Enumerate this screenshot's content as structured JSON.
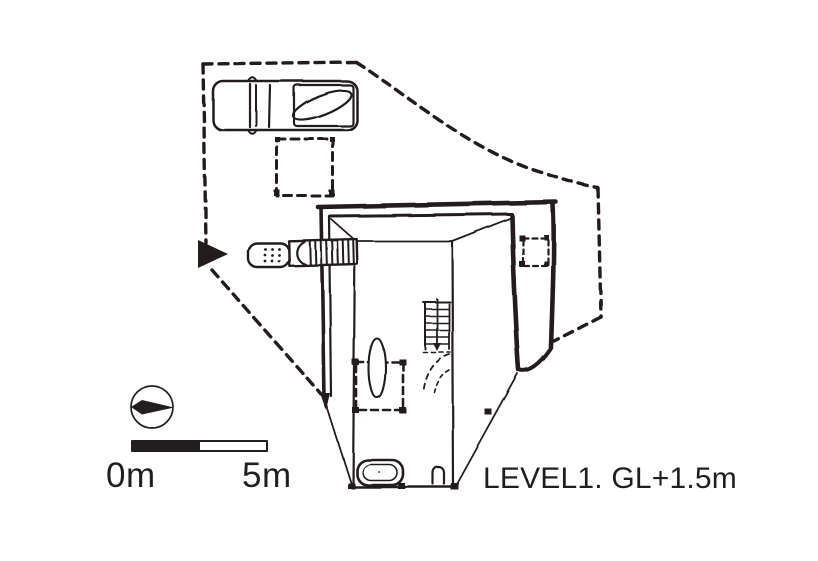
{
  "drawing": {
    "kind_note": "hand-drawn floor plan",
    "level_label": "LEVEL1. GL+1.5m"
  },
  "scale_bar": {
    "start_label": "0m",
    "end_label": "5m"
  },
  "colors": {
    "ink": "#221e1f",
    "paper": "#ffffff"
  },
  "icons": {
    "north_arrow": "compass-needle-in-circle",
    "entry_arrow": "filled-triangle-pointing-right"
  }
}
